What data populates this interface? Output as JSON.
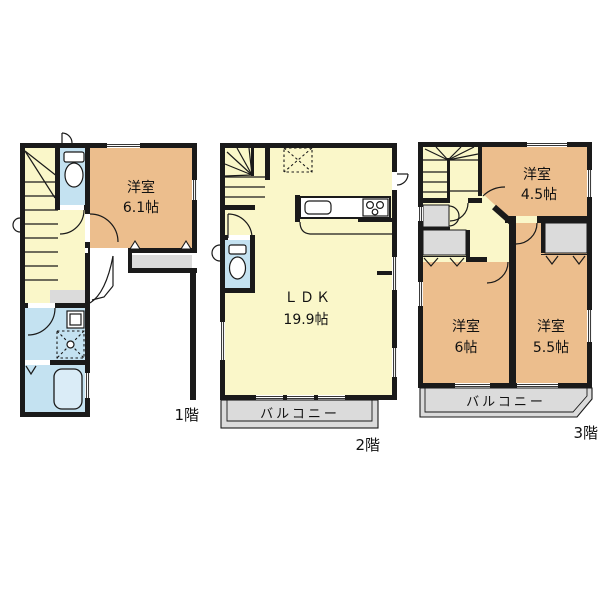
{
  "fp": {
    "f1": {
      "label": "1階",
      "room": {
        "name": "洋室",
        "size": "6.1帖"
      }
    },
    "f2": {
      "label": "2階",
      "ldk": {
        "name": "ＬＤＫ",
        "size": "19.9帖"
      },
      "balcony": "バルコニー"
    },
    "f3": {
      "label": "3階",
      "room45": {
        "name": "洋室",
        "size": "4.5帖"
      },
      "room6": {
        "name": "洋室",
        "size": "6帖"
      },
      "room55": {
        "name": "洋室",
        "size": "5.5帖"
      },
      "balcony": "バルコニー"
    }
  },
  "colors": {
    "wall": "#1a1a1a",
    "room": "#ecbe8d",
    "hall": "#faf7c9",
    "wet": "#c4e2f1",
    "tub": "#daecf7",
    "gray": "#dbdbdb",
    "text": "#111111",
    "bg": "#ffffff"
  }
}
